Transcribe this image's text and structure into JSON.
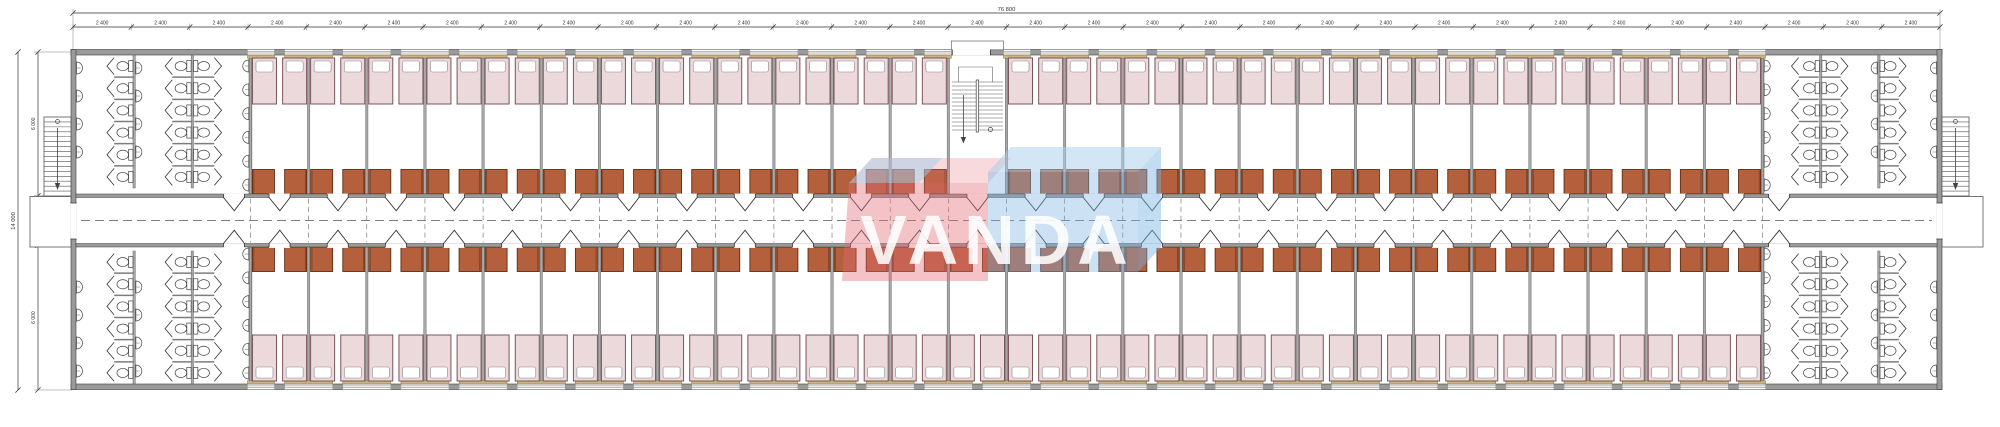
{
  "watermark": {
    "text": "VANDA"
  },
  "dimensions": {
    "top_total": "76 800",
    "top_segments": {
      "label": "2 400",
      "count": 32
    },
    "left_total": "14 000",
    "left_segments": [
      "6 000",
      "2 000",
      "6 000"
    ]
  },
  "plan": {
    "bays": 32,
    "washroom_bays_per_end": 3,
    "stair_bay_from_left": 16,
    "first_room_bay": 4,
    "last_room_bay": 29,
    "stall_columns_per_washroom": 3,
    "stalls_per_column": 6,
    "wall_sinks_per_column": 4,
    "inner_sinks_per_column": 6,
    "beds_per_room": 2,
    "wardrobes_per_room": 2
  },
  "colors": {
    "wall_fill": "#9a9a9a",
    "wall_edge": "#3d3d3d",
    "partition": "#a8a8a8",
    "partition_edge": "#555555",
    "stall_wall": "#7d7d7d",
    "line": "#333333",
    "fixture_edge": "#444444",
    "bed_fill": "#ecd9dc",
    "bed_edge": "#7a555c",
    "pillow_fill": "#ffffff",
    "pillow_edge": "#888888",
    "tan_fill": "#c8b57b",
    "tan_edge": "#85703a",
    "wardrobe_fill": "#b5603c",
    "wardrobe_edge": "#5e2d12",
    "dash": "#555555",
    "dim_text": "#333333",
    "watermark_red": "rgba(226,106,114,0.40)",
    "watermark_red_top": "rgba(226,106,114,0.25)",
    "watermark_blue": "rgba(120,178,226,0.38)",
    "watermark_blue_top": "rgba(165,205,235,0.50)",
    "watermark_blue_side": "rgba(120,178,226,0.45)",
    "watermark_text": "rgba(255,255,255,0.88)"
  }
}
